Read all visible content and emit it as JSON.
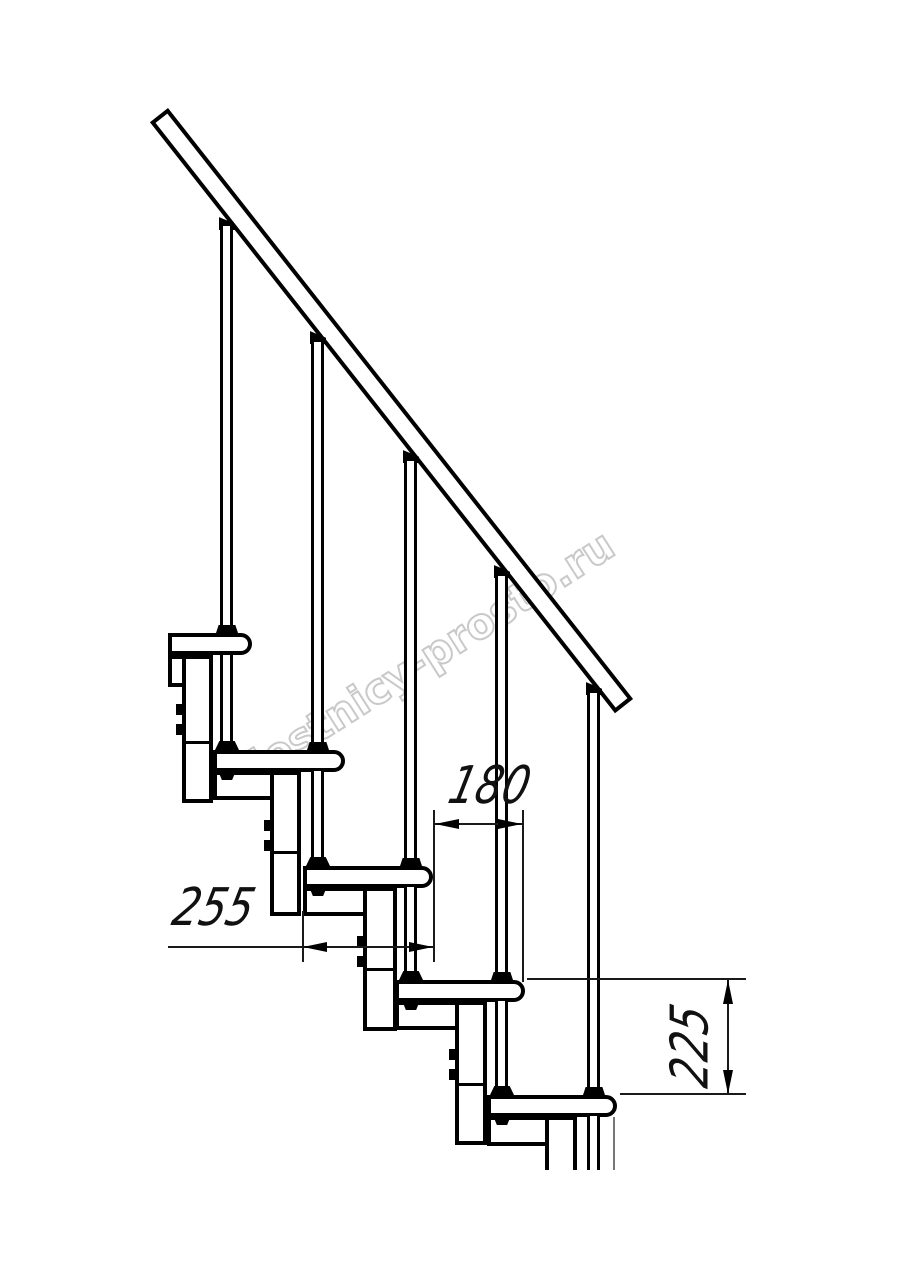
{
  "drawing": {
    "watermark": "lestnicy-prosto.ru",
    "dimensions": {
      "run_mm": "180",
      "tread_depth_mm": "255",
      "rise_mm": "225"
    }
  }
}
